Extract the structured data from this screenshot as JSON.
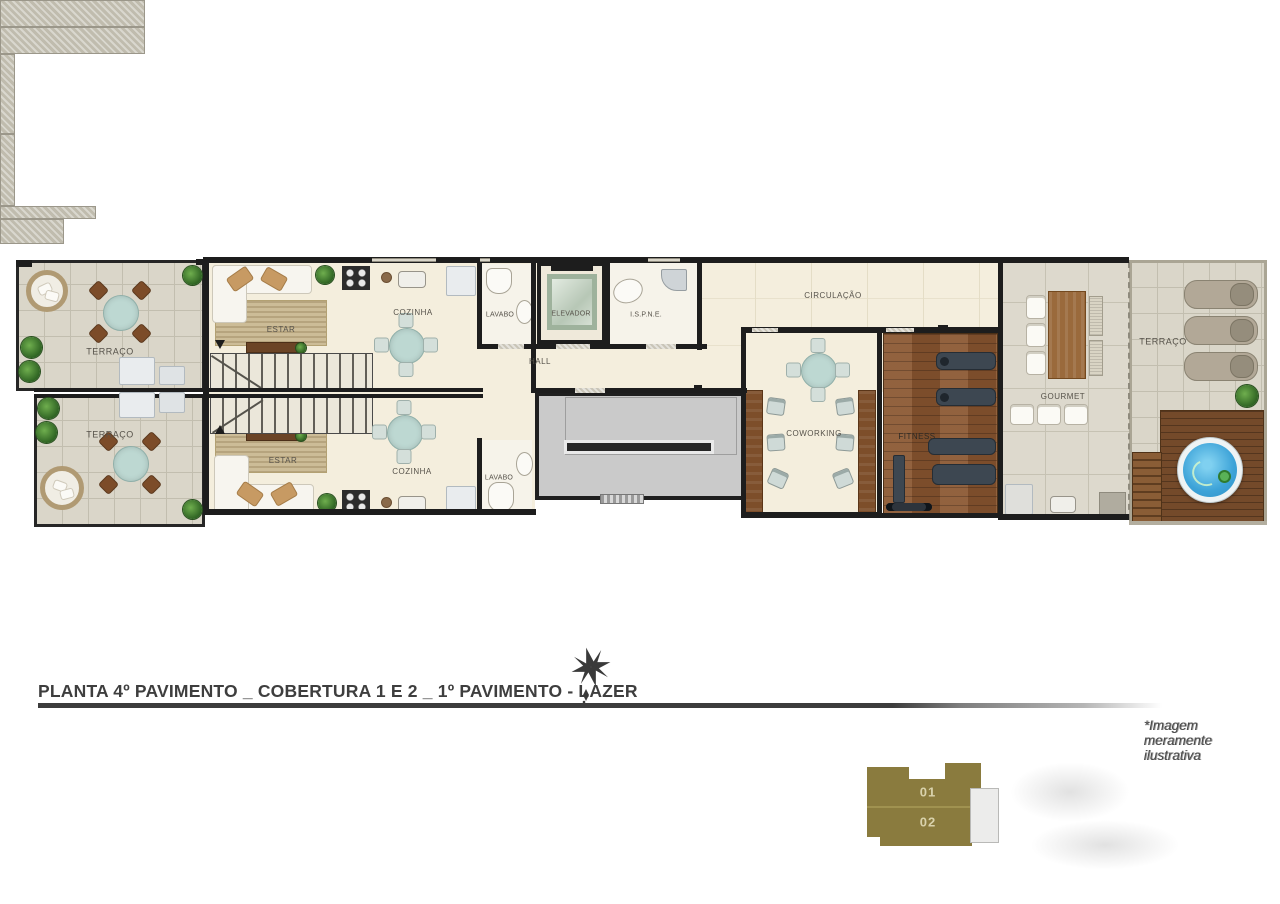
{
  "title": {
    "text": "PLANTA 4º PAVIMENTO _ COBERTURA 1 E 2 _ 1º PAVIMENTO - LAZER"
  },
  "disclaimer": "*Imagem meramente ilustrativa",
  "rooms": {
    "terraco_tl": "TERRAÇO",
    "terraco_bl": "TERRAÇO",
    "estar_1": "ESTAR",
    "estar_2": "ESTAR",
    "cozinha_1": "COZINHA",
    "cozinha_2": "COZINHA",
    "lavabo_1": "LAVABO",
    "lavabo_2": "LAVABO",
    "elevador": "ELEVADOR",
    "ispne": "I.S.P.N.E.",
    "hall": "HALL",
    "circulacao": "CIRCULAÇÃO",
    "coworking": "COWORKING",
    "fitness": "FITNESS",
    "gourmet": "GOURMET",
    "terraco_right": "TERRAÇO"
  },
  "keyplan": {
    "unit_top": "01",
    "unit_bottom": "02"
  },
  "colors": {
    "wall": "#1d1d1d",
    "floor_cream": "#f4eedd",
    "stone_tile": "#dad6c9",
    "wood": "#8a5630",
    "deck_wood": "#744a2a",
    "pool_water": "#3da3d8",
    "keyplan_olive": "#8a7b3e",
    "table_teal": "#bdd8d2",
    "title_gray": "#3e3e3e"
  }
}
